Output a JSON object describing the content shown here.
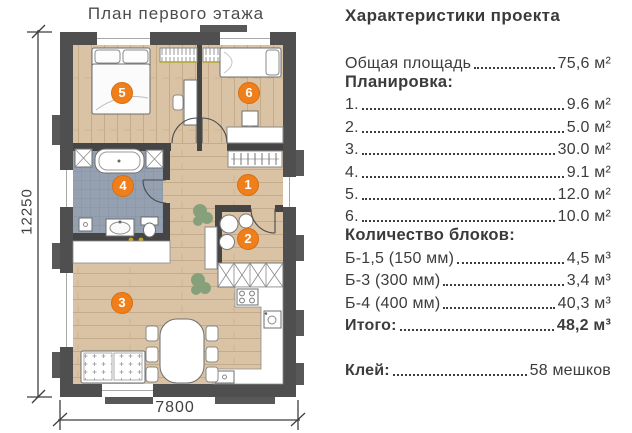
{
  "plan": {
    "title": "План первого этажа",
    "dim_vertical": "12250",
    "dim_horizontal": "7800",
    "markers": [
      "1",
      "2",
      "3",
      "4",
      "5",
      "6"
    ]
  },
  "specs": {
    "heading": "Характеристики проекта",
    "total": {
      "label": "Общая площадь",
      "value": "75,6 м²"
    },
    "layout_heading": "Планировка:",
    "rooms": [
      {
        "label": "1.",
        "value": "9.6 м²"
      },
      {
        "label": "2.",
        "value": "5.0 м²"
      },
      {
        "label": "3.",
        "value": "30.0 м²"
      },
      {
        "label": "4.",
        "value": "9.1 м²"
      },
      {
        "label": "5.",
        "value": "12.0 м²"
      },
      {
        "label": "6.",
        "value": "10.0 м²"
      }
    ],
    "blocks_heading": "Количество блоков:",
    "blocks": [
      {
        "label": "Б-1,5 (150 мм)",
        "value": "4,5 м³"
      },
      {
        "label": "Б-3 (300 мм)",
        "value": "3,4 м³"
      },
      {
        "label": "Б-4 (400 мм)",
        "value": "40,3 м³"
      }
    ],
    "blocks_total": {
      "label": "Итого:",
      "value": "48,2 м³"
    },
    "glue": {
      "label": "Клей:",
      "value": "58 мешков"
    }
  },
  "colors": {
    "accent_orange": "#EF7F1A",
    "wall_gray": "#4F4F4F",
    "floor_wood": "#D9C3A4",
    "floor_tile": "#95A1B0",
    "text": "#3C3C3C"
  }
}
